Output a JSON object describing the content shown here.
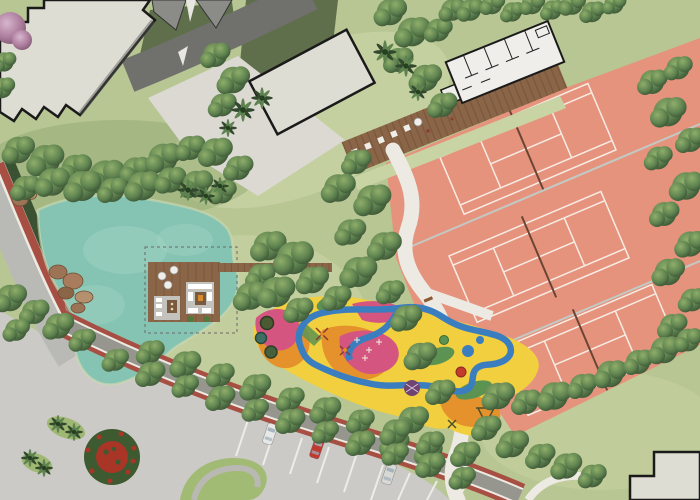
{
  "title": "Landscape master plan rendering - pond, lounge deck, playground and tennis courts",
  "palette": {
    "lawn": "#b7c693",
    "lawnPale": "#c9d4a4",
    "lawnDark": "#5f6f4b",
    "treeLight": "#8fae6a",
    "treeMid": "#5f8350",
    "treeDark": "#32492e",
    "pond": "#85c3b2",
    "pondLight": "#a3d4c4",
    "court": "#e6937d",
    "courtLine": "#f7ece4",
    "building": "#deddd3",
    "buildingWhite": "#efeeea",
    "outline": "#1a1a1a",
    "roadDark": "#70706c",
    "roadGray": "#b9b9b5",
    "plaza": "#cbcac6",
    "plazaLight": "#dbd9d2",
    "pathWhite": "#eceae3",
    "wood": "#8a6547",
    "woodDark": "#65472f",
    "redStrip": "#a84f44",
    "hedge": "#3a5232",
    "playYellow": "#f2cf3f",
    "playOrange": "#e6922c",
    "playPink": "#d45680",
    "playBlue": "#3b7ec0",
    "playGreen": "#5d9352",
    "flowerGreen": "#3e5a30",
    "flowerRed": "#a93527",
    "rug": "#c4c2bc",
    "rock": "#9c7355",
    "carRed": "#c03a30",
    "carWhite": "#e8e8e6",
    "carGray": "#d8d8d4"
  },
  "features": {
    "tennis_courts": 3,
    "building_footprints": 4,
    "parked_cars": 3,
    "playground_trampolines": 3,
    "timber_decks": 2,
    "flower_roundabout": 1,
    "pond": 1
  }
}
